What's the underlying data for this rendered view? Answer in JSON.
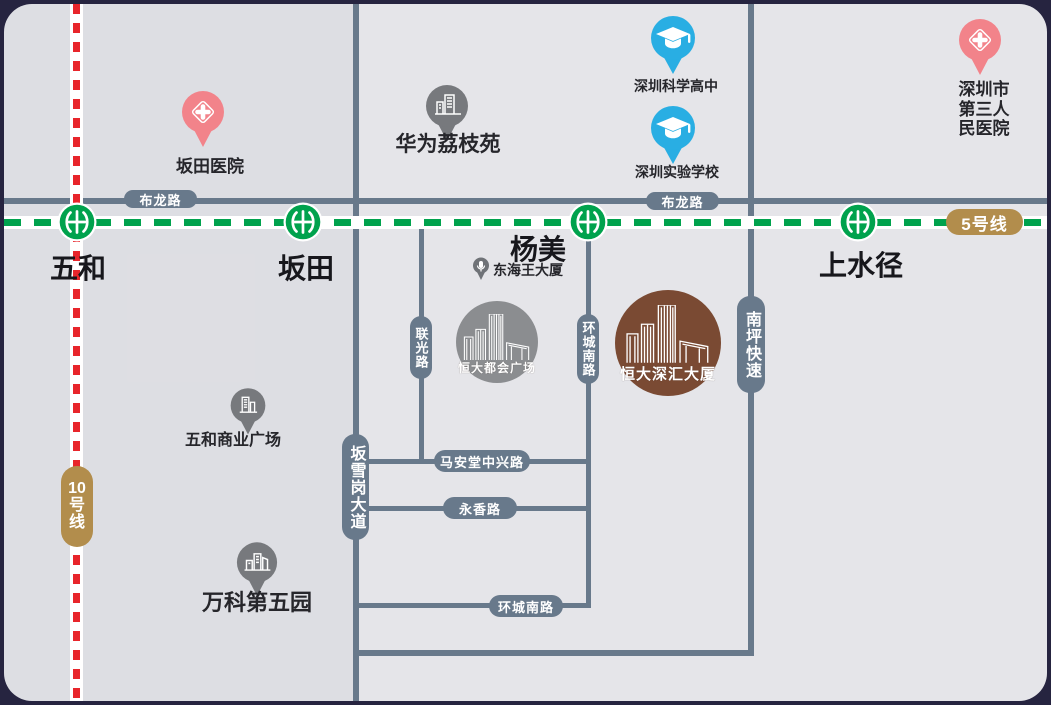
{
  "metro": {
    "line5": {
      "name": "5号线",
      "color": "#00a24d",
      "badge_color": "#b28d4c"
    },
    "line10": {
      "name": "10号线",
      "parts": [
        "10",
        "号",
        "线"
      ],
      "color": "#e8252b",
      "badge_color": "#b28d4c"
    },
    "stations": [
      {
        "name": "五和"
      },
      {
        "name": "坂田"
      },
      {
        "name": "杨美"
      },
      {
        "name": "上水径"
      }
    ]
  },
  "roads": {
    "bulong_left": "布龙路",
    "bulong_right": "布龙路",
    "banxuegang": "坂雪岗大道",
    "lianguang": "联光路",
    "huancheng_v": "环城南路",
    "nanping": "南坪快速",
    "maantang": "马安堂中兴路",
    "yongxiang": "永香路",
    "huancheng_h": "环城南路",
    "road_color": "#68798b"
  },
  "pois": [
    {
      "label": "坂田医院",
      "type": "hospital",
      "pin_color": "#f2838a"
    },
    {
      "label": "华为荔枝苑",
      "type": "building",
      "pin_color": "#77797d"
    },
    {
      "label": "深圳科学高中",
      "type": "school",
      "pin_color": "#29aee3"
    },
    {
      "label": "深圳实验学校",
      "type": "school",
      "pin_color": "#29aee3"
    },
    {
      "label": "深圳市\n第三人民医院",
      "type": "hospital",
      "pin_color": "#f2838a"
    },
    {
      "label": "东海王大厦",
      "type": "building-small",
      "pin_color": "#6f7277"
    },
    {
      "label": "五和商业广场",
      "type": "building",
      "pin_color": "#77797d"
    },
    {
      "label": "万科第五园",
      "type": "building",
      "pin_color": "#77797d"
    }
  ],
  "projects": [
    {
      "name": "恒大都会广场",
      "circle_color": "#8b8d90"
    },
    {
      "name": "恒大深汇大厦",
      "circle_color": "#7a4a33"
    }
  ]
}
